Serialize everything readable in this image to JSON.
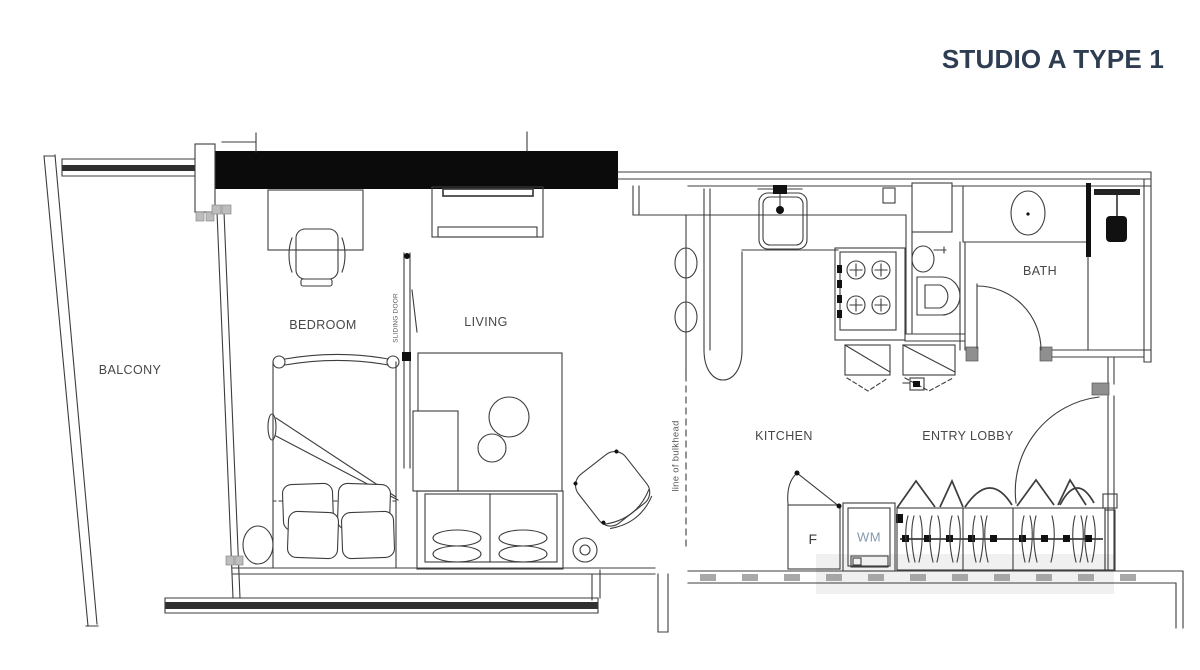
{
  "title": "STUDIO A TYPE 1",
  "colors": {
    "background": "#ffffff",
    "title_text": "#2e3d52",
    "line": "#3d3d3d",
    "structural_wall_fill": "#0b0b0b",
    "label_text": "#474747",
    "wm_text": "#8498b0"
  },
  "rooms": {
    "balcony": {
      "label": "BALCONY"
    },
    "bedroom": {
      "label": "BEDROOM"
    },
    "living": {
      "label": "LIVING"
    },
    "kitchen": {
      "label": "KITCHEN"
    },
    "entry_lobby": {
      "label": "ENTRY LOBBY"
    },
    "bath": {
      "label": "BATH"
    }
  },
  "annotations": {
    "sliding_door": "SLIDING DOOR",
    "line_of_bulkhead": "line of bulkhead",
    "fridge": "F",
    "washing_machine": "WM"
  }
}
